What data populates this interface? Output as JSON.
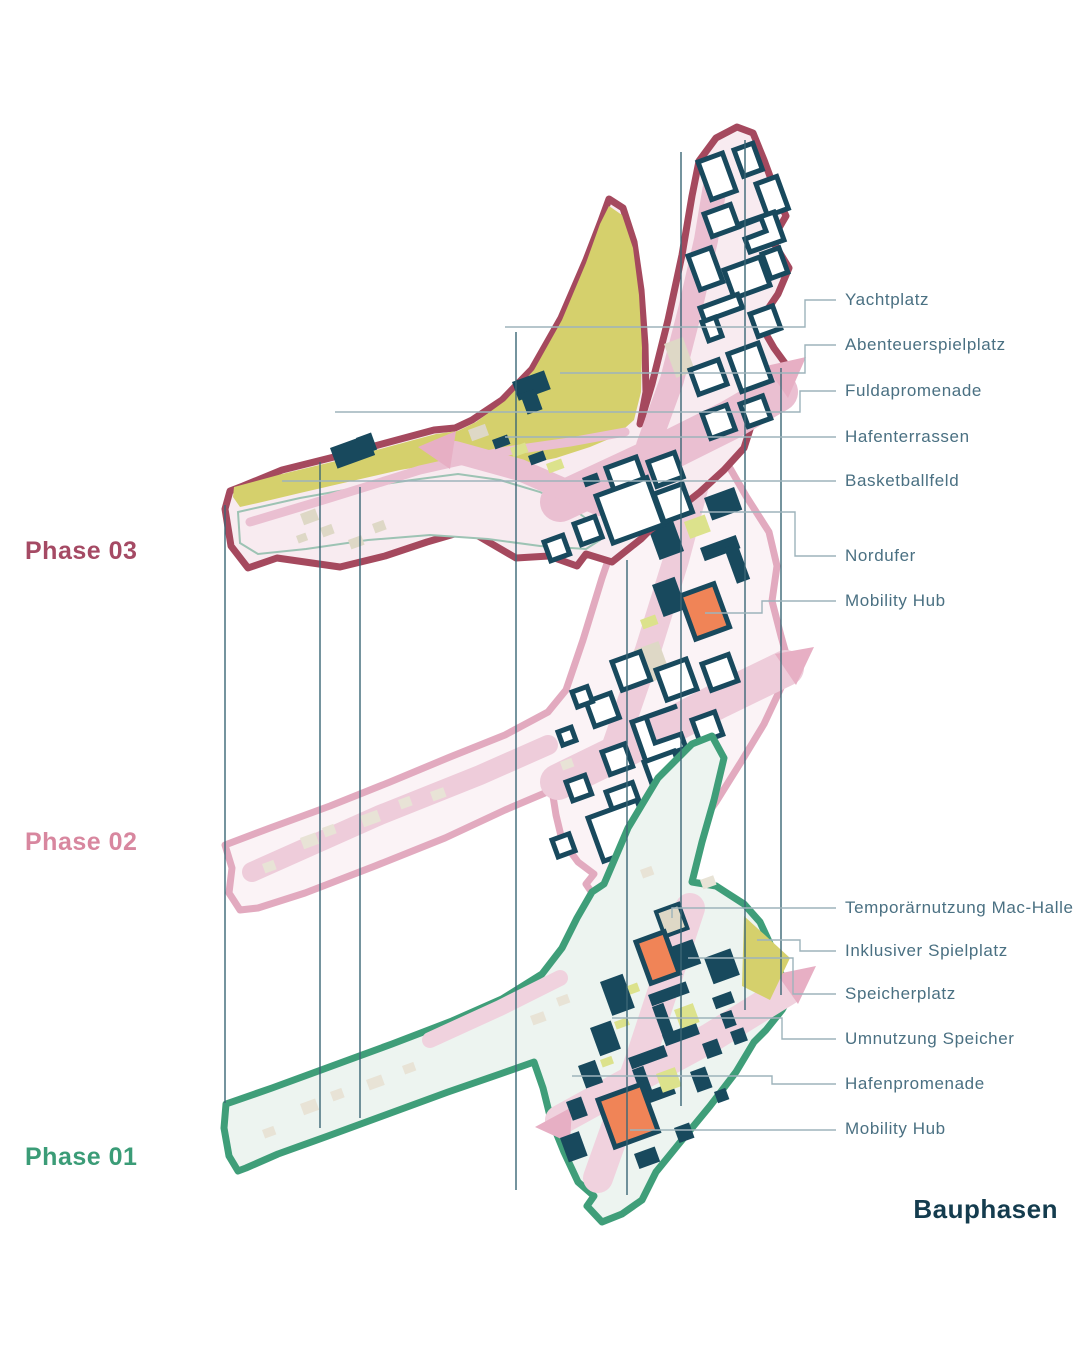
{
  "title": "Bauphasen",
  "phase_labels": [
    {
      "label": "Phase 03",
      "color": "#a54a64"
    },
    {
      "label": "Phase 02",
      "color": "#d8879f"
    },
    {
      "label": "Phase 01",
      "color": "#3b9c77"
    }
  ],
  "annotations_top": [
    {
      "label": "Yachtplatz"
    },
    {
      "label": "Abenteuerspielplatz"
    },
    {
      "label": "Fuldapromenade"
    },
    {
      "label": "Hafenterrassen"
    },
    {
      "label": "Basketballfeld"
    },
    {
      "label": "Nordufer"
    },
    {
      "label": "Mobility Hub"
    }
  ],
  "annotations_bottom": [
    {
      "label": "Temporärnutzung Mac-Halle"
    },
    {
      "label": "Inklusiver Spielplatz"
    },
    {
      "label": "Speicherplatz"
    },
    {
      "label": "Umnutzung Speicher"
    },
    {
      "label": "Hafenpromenade"
    },
    {
      "label": "Mobility Hub"
    }
  ],
  "colors": {
    "phase3_outline": "#a5495e",
    "phase3_fill": "#f8ebf0",
    "phase2_outline": "#e2aabf",
    "phase2_fill": "#fbf3f6",
    "phase1_outline": "#3f9e79",
    "phase1_fill": "#edf4f0",
    "park_olive": "#d5d06c",
    "accent_olive": "#dce28c",
    "building_teal": "#18495d",
    "building_white": "#ffffff",
    "mobility_hub_orange": "#f08457",
    "road_pink": "#eabfd1",
    "beige": "#ded8c6",
    "guide_line": "#3a6675",
    "connector_line": "#9db3bb",
    "annotation_text": "#4a7082",
    "title_color": "#143c4e"
  }
}
